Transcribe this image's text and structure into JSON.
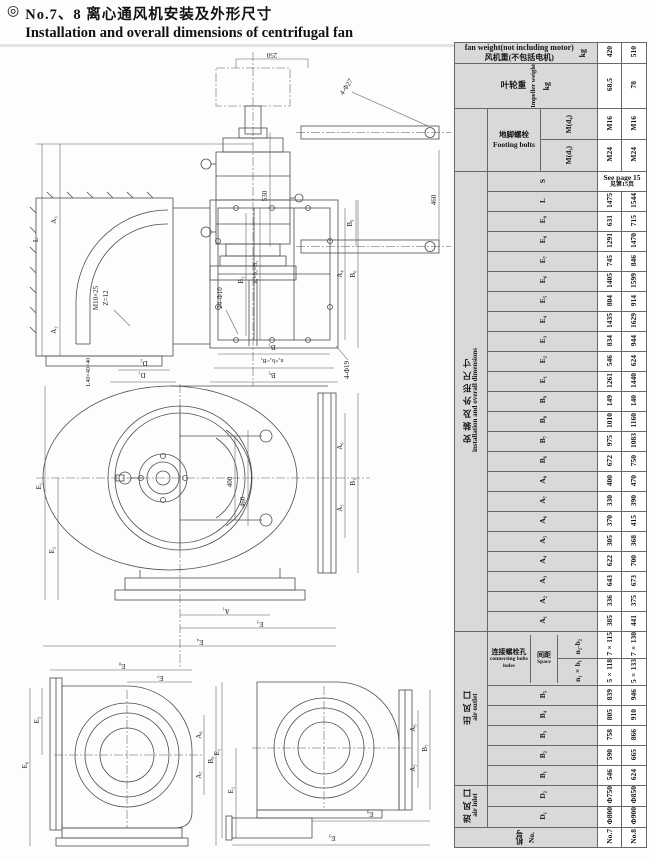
{
  "title": {
    "bullet": "◎",
    "zh": "No.7、8 离心通风机安装及外形尺寸",
    "en": "Installation and overall dimensions of centrifugal fan"
  },
  "table": {
    "fan_weight": {
      "en": "fan weight(not including motor)",
      "zh": "风机重(不包括电机)",
      "unit": "kg",
      "no7": "420",
      "no8": "510"
    },
    "impeller": {
      "zh": "叶轮重",
      "en": "Impeller weight",
      "unit": "kg",
      "no7": "68.5",
      "no8": "78"
    },
    "footing": {
      "zh": "地脚螺栓",
      "en": "Footing bolts",
      "rows": [
        {
          "label": "M(d₄)",
          "no7": "M16",
          "no8": "M16"
        },
        {
          "label": "M(d₃)",
          "no7": "M24",
          "no8": "M24"
        }
      ]
    },
    "install_group": {
      "zh": "安 装 及 外 形 尺 寸",
      "en": "installation and overall dimensions"
    },
    "s_row": {
      "label": "S",
      "en": "See page 15",
      "zh": "见第15页"
    },
    "dims": [
      {
        "label": "L",
        "no7": "1475",
        "no8": "1544"
      },
      {
        "label": "E₉",
        "no7": "631",
        "no8": "715"
      },
      {
        "label": "E₈",
        "no7": "1291",
        "no8": "1470"
      },
      {
        "label": "E₇",
        "no7": "745",
        "no8": "846"
      },
      {
        "label": "E₆",
        "no7": "1405",
        "no8": "1599"
      },
      {
        "label": "E₅",
        "no7": "804",
        "no8": "914"
      },
      {
        "label": "E₄",
        "no7": "1435",
        "no8": "1629"
      },
      {
        "label": "E₃",
        "no7": "834",
        "no8": "944"
      },
      {
        "label": "E₂",
        "no7": "546",
        "no8": "624"
      },
      {
        "label": "E₁",
        "no7": "1261",
        "no8": "1440"
      },
      {
        "label": "B₉",
        "no7": "149",
        "no8": "140"
      },
      {
        "label": "B₈",
        "no7": "1010",
        "no8": "1160"
      },
      {
        "label": "B₇",
        "no7": "975",
        "no8": "1083"
      },
      {
        "label": "B₆",
        "no7": "672",
        "no8": "750"
      },
      {
        "label": "A₈",
        "no7": "400",
        "no8": "470"
      },
      {
        "label": "A₇",
        "no7": "330",
        "no8": "390"
      },
      {
        "label": "A₆",
        "no7": "370",
        "no8": "415"
      },
      {
        "label": "A₅",
        "no7": "305",
        "no8": "368"
      },
      {
        "label": "A₄",
        "no7": "622",
        "no8": "700"
      },
      {
        "label": "A₃",
        "no7": "643",
        "no8": "673"
      },
      {
        "label": "A₂",
        "no7": "336",
        "no8": "375"
      },
      {
        "label": "A₁",
        "no7": "385",
        "no8": "441"
      }
    ],
    "outlet_group": {
      "zh": "出 风 口",
      "en": "air outlet"
    },
    "holes": {
      "zh": "连接螺栓孔",
      "en": "connecting bolts holes",
      "space_zh": "间距",
      "space_en": "Space",
      "rows": [
        {
          "label": "n₂-b₂",
          "no7": "7×115",
          "no8": "7×130"
        },
        {
          "label": "n₁×b₁",
          "no7": "5×118",
          "no8": "5×133"
        }
      ]
    },
    "outlet_dims": [
      {
        "label": "B₅",
        "no7": "839",
        "no8": "946"
      },
      {
        "label": "B₄",
        "no7": "805",
        "no8": "910"
      },
      {
        "label": "B₃",
        "no7": "758",
        "no8": "866"
      },
      {
        "label": "B₂",
        "no7": "590",
        "no8": "665"
      },
      {
        "label": "B₁",
        "no7": "546",
        "no8": "624"
      }
    ],
    "inlet_group": {
      "zh": "进 风 口",
      "en": "air inlet"
    },
    "inlet_dims": [
      {
        "label": "D₂",
        "no7": "Φ750",
        "no8": "Φ850"
      },
      {
        "label": "D₁",
        "no7": "Φ800",
        "no8": "Φ900"
      }
    ],
    "model": {
      "zh": "机号",
      "en": "No.",
      "no7": "No.7",
      "no8": "No.8"
    }
  },
  "drawings": {
    "view1": {
      "top_width": "250",
      "arm_holes": "4-Φ27",
      "arm_span": "530",
      "right_span": "460",
      "b9": "B₉",
      "overall": "L",
      "a3": "A₃",
      "a2": "A₂",
      "bolt_note": "M10×25",
      "blade_note": "Z=12",
      "angle_note": "L40×40×40",
      "d2": "D₂",
      "d1": "D₁",
      "outlet_holes": "24-Φ10",
      "b1": "B₁",
      "nb2": "n₁×b₁=B₂",
      "a4": "A₄",
      "b6": "B₆",
      "foot_holes": "4-Φ19",
      "b3": "B₃",
      "nb4": "n₂×b₂=B₄",
      "b5": "B₅"
    },
    "view2": {
      "e1": "E₁",
      "e2": "E₂",
      "r400": "400",
      "r460": "460",
      "a6": "A₆",
      "a5": "A₅",
      "b7": "B₇",
      "a1": "A₁",
      "e3": "E₃",
      "e4": "E₄"
    },
    "view3": {
      "e8": "E₈",
      "e7": "E₇",
      "e5": "E₅",
      "e6": "E₆",
      "a8": "A₈",
      "a7": "A₇",
      "b8": "B₈"
    },
    "view4": {
      "e1": "E₁",
      "e2": "E₂",
      "a6": "A₆",
      "a5": "A₅",
      "b7": "B₇",
      "e9": "E₉",
      "e3": "E₃"
    }
  }
}
